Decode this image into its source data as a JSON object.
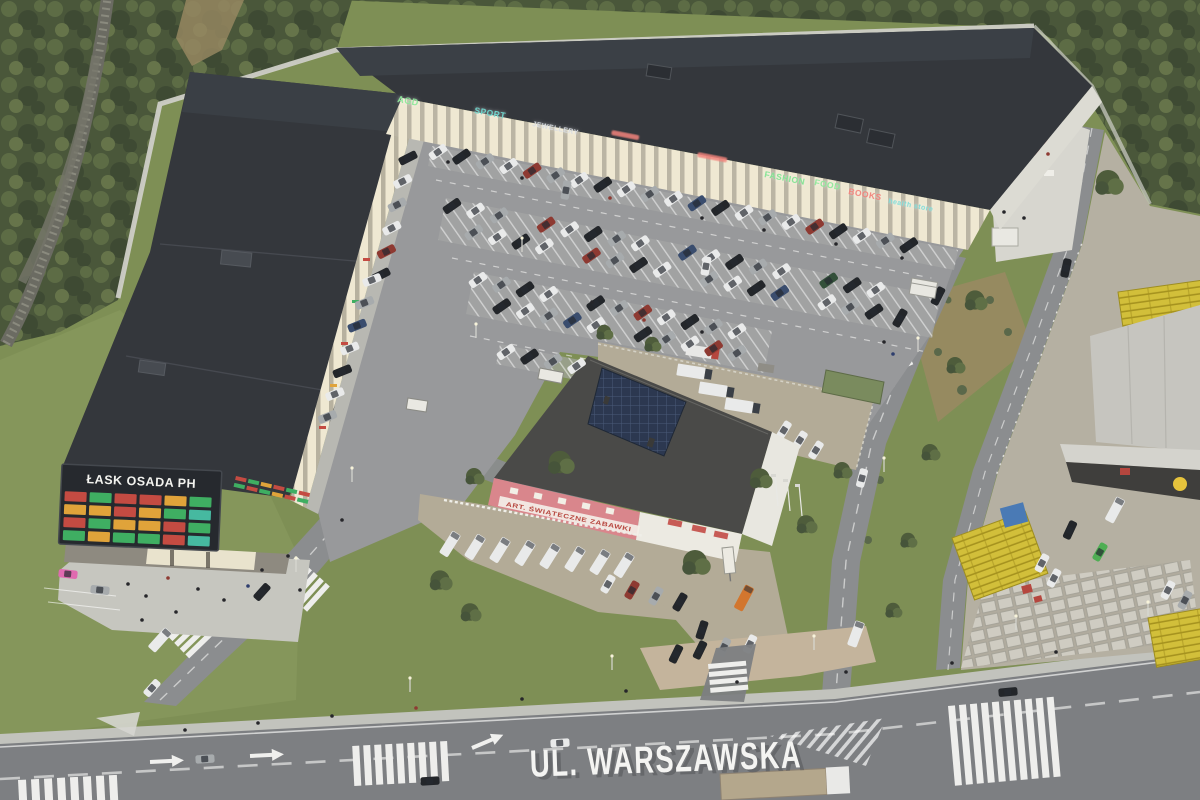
{
  "scene": {
    "type": "aerial-architectural-visualization",
    "subject": "ŁASK OSADA PH retail park"
  },
  "pylon_sign": {
    "title": "ŁASK OSADA PH",
    "tile_colors": [
      "#c44b42",
      "#3fae62",
      "#c44b42",
      "#c44b42",
      "#e0a33a",
      "#3fae62",
      "#e0a33a",
      "#e0a33a",
      "#c44b42",
      "#e0a33a",
      "#3fae62",
      "#46b9a0",
      "#c44b42",
      "#3fae62",
      "#e0a33a",
      "#e0a33a",
      "#c44b42",
      "#3fae62",
      "#3fae62",
      "#e0a33a",
      "#3fae62",
      "#3fae62",
      "#c44b42",
      "#46b9a0"
    ]
  },
  "storefront_signs": [
    {
      "label": "AGD",
      "color": "#8ee89a"
    },
    {
      "label": "SPORT",
      "color": "#6fd9cf"
    },
    {
      "label": "JEWELLERY",
      "color": "#d9dde2"
    },
    {
      "label": "FASHION",
      "color": "#82e392"
    },
    {
      "label": "FOOD",
      "color": "#8ee89a"
    },
    {
      "label": "BOOKS",
      "color": "#f2837b"
    },
    {
      "label": "health store",
      "color": "#7fdcd8"
    }
  ],
  "pink_building": {
    "sign": "ART. ŚWIĄTECZNE ZABAWKI"
  },
  "street": {
    "label": "UL. WARSZAWSKA"
  },
  "palette": {
    "grass": "#7e8f55",
    "grass-light": "#91a065",
    "forest": "#4a573a",
    "forest-2": "#5d6c45",
    "forest-3": "#3e4a33",
    "roof": "#34373c",
    "roof-2": "#3b4046",
    "roof-seam": "#565a60",
    "facade": "#efe8d2",
    "wall": "#cfcfc7",
    "asphalt": "#98999b",
    "stall": "#a6a7a6",
    "road": "#8b8d8f",
    "road-main": "#7d7f82",
    "sidewalk": "#c2c3bd",
    "plaza": "#c6c6bf",
    "paver": "#c4b49c",
    "gravel": "#b3ab97",
    "marking": "#eeeeec",
    "pink": "#d9868c",
    "pink-roof": "#4a4a48",
    "solar": "#2c3850",
    "white-bldg": "#eceae2",
    "crate": "#d2bf3a",
    "crate-dark": "#a6931f",
    "depot": "#b5b0a2",
    "wh-roof": "#c6c5bf",
    "wh-front": "#3f3e3c",
    "logo": "#e6c33c",
    "board": "#26292e",
    "street-text": "#f4f4f2",
    "dirt": "#9a8a63",
    "sign-red": "#c44b42",
    "sign-green": "#3fae62",
    "sign-orange": "#e0a33a",
    "sign-teal": "#46b9a0",
    "car-white": "#e9eaea",
    "car-black": "#23262a",
    "car-silver": "#a7abad",
    "car-red": "#8e3a32",
    "car-green": "#33503a",
    "car-blue": "#3a4d6e",
    "car-pink": "#e06ab0",
    "orange-van": "#d2762e",
    "green-bright": "#4fae54",
    "tree-1": "#4e5c3b",
    "tree-2": "#5f6f46",
    "tree-3": "#46543a",
    "shrub": "#5a684a"
  }
}
